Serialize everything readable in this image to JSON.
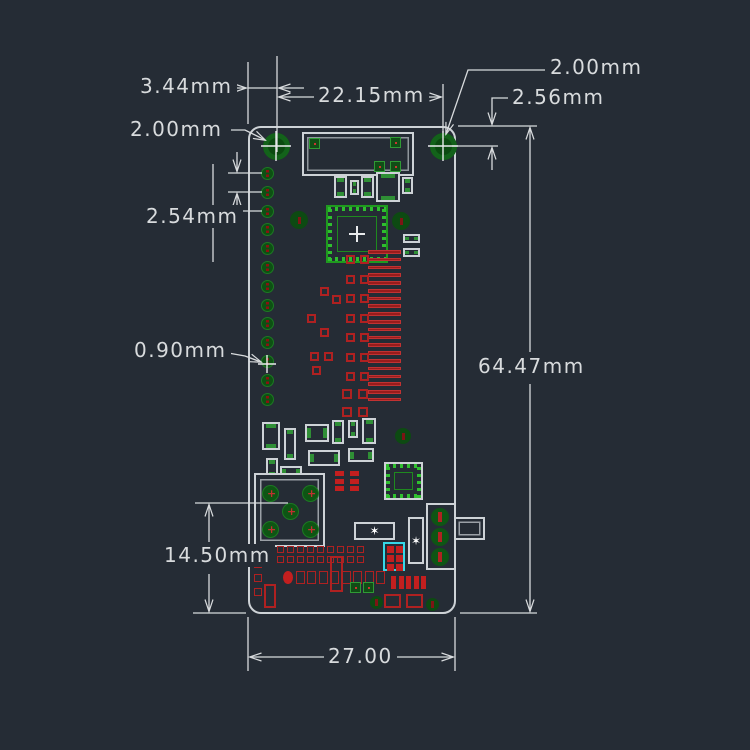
{
  "drawing": {
    "type": "pcb-dimension-drawing",
    "units": "mm",
    "background_color": "#252C35",
    "annotation_color": "#D8DBDD",
    "dims": {
      "edge_to_hole": "3.44mm",
      "hole_spacing": "22.15mm",
      "hole_dia_right": "2.00mm",
      "top_edge_to_hole": "2.56mm",
      "hole_dia_left": "2.00mm",
      "header_pitch": "2.54mm",
      "pad_drill": "0.90mm",
      "board_length": "64.47mm",
      "connector_to_edge": "14.50mm",
      "board_width": "27.00"
    },
    "board": {
      "outline_color": "#CDD2D6",
      "copper_bright": "#2FBF2F",
      "pad_fill": "#0E5514",
      "silkscreen_color": "#C13232",
      "highlight_color": "#35D8E8",
      "left_header_pin_count": 13,
      "mounting_hole_count": 2
    }
  }
}
